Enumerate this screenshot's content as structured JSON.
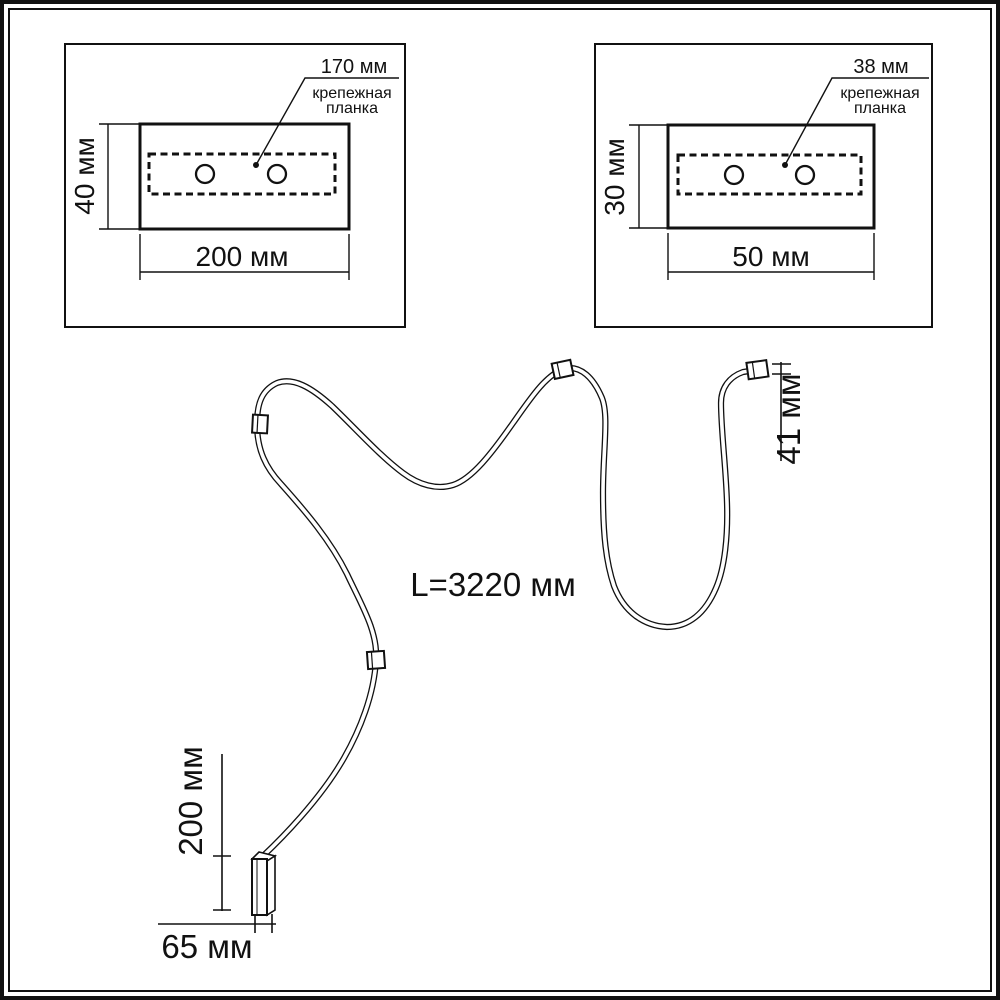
{
  "panels": {
    "left": {
      "hole_spacing": "170 мм",
      "plate_line1": "крепежная",
      "plate_line2": "планка",
      "height": "40 мм",
      "width": "200 мм"
    },
    "right": {
      "hole_spacing": "38 мм",
      "plate_line1": "крепежная",
      "plate_line2": "планка",
      "height": "30 мм",
      "width": "50 мм"
    }
  },
  "cable": {
    "length": "L=3220 мм",
    "tip": "41 мм",
    "head_length": "200 мм",
    "head_width": "65 мм"
  },
  "colors": {
    "ink": "#111111",
    "background": "#ffffff"
  }
}
